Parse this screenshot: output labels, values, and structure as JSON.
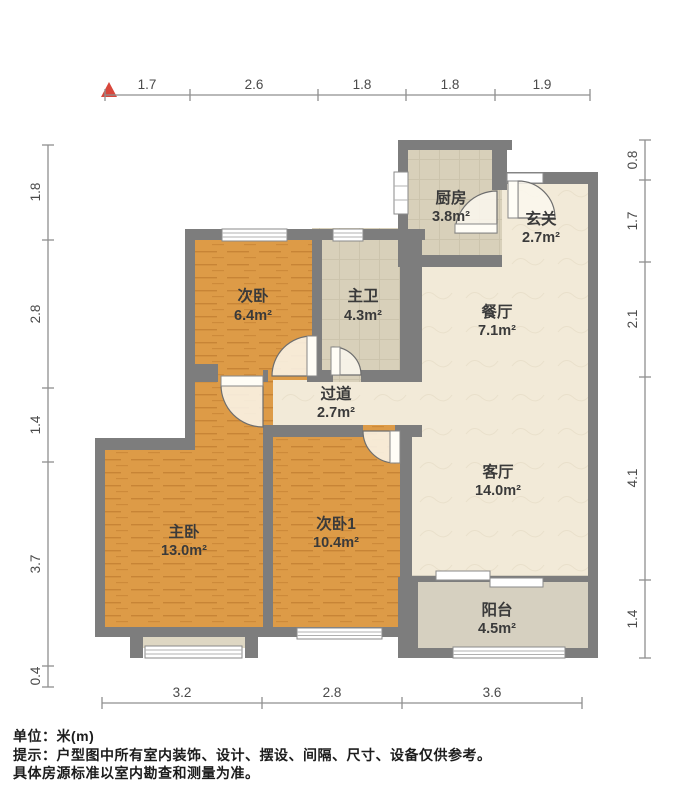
{
  "meta": {
    "unit_label": "单位：米(m)",
    "note_line1": "提示：户型图中所有室内装饰、设计、摆设、间隔、尺寸、设备仅供参考。",
    "note_line2": "具体房源标准以室内勘查和测量为准。"
  },
  "colors": {
    "accent_red": "#d8473c",
    "wall_gray": "#7d7d7d",
    "wood_floor": "#dd9b47",
    "cream_floor": "#f2ead8",
    "tile_floor": "#d8d0ba",
    "balcony_floor": "#d6d0c0",
    "dim_color": "#4a4a4a",
    "room_text": "#3a3a3a"
  },
  "dimensions": {
    "top": [
      "1.7",
      "2.6",
      "1.8",
      "1.8",
      "1.9"
    ],
    "left": [
      "1.8",
      "2.8",
      "1.4",
      "3.7",
      "0.4"
    ],
    "right": [
      "0.8",
      "1.7",
      "2.1",
      "4.1",
      "1.4"
    ],
    "bottom": [
      "3.2",
      "2.8",
      "3.6"
    ]
  },
  "rooms": {
    "kitchen": {
      "name": "厨房",
      "area": "3.8m²"
    },
    "entry": {
      "name": "玄关",
      "area": "2.7m²"
    },
    "bedroom2": {
      "name": "次卧",
      "area": "6.4m²"
    },
    "master_bath": {
      "name": "主卫",
      "area": "4.3m²"
    },
    "dining": {
      "name": "餐厅",
      "area": "7.1m²"
    },
    "hallway": {
      "name": "过道",
      "area": "2.7m²"
    },
    "living": {
      "name": "客厅",
      "area": "14.0m²"
    },
    "master_bedroom": {
      "name": "主卧",
      "area": "13.0m²"
    },
    "bedroom1": {
      "name": "次卧1",
      "area": "10.4m²"
    },
    "balcony": {
      "name": "阳台",
      "area": "4.5m²"
    }
  }
}
